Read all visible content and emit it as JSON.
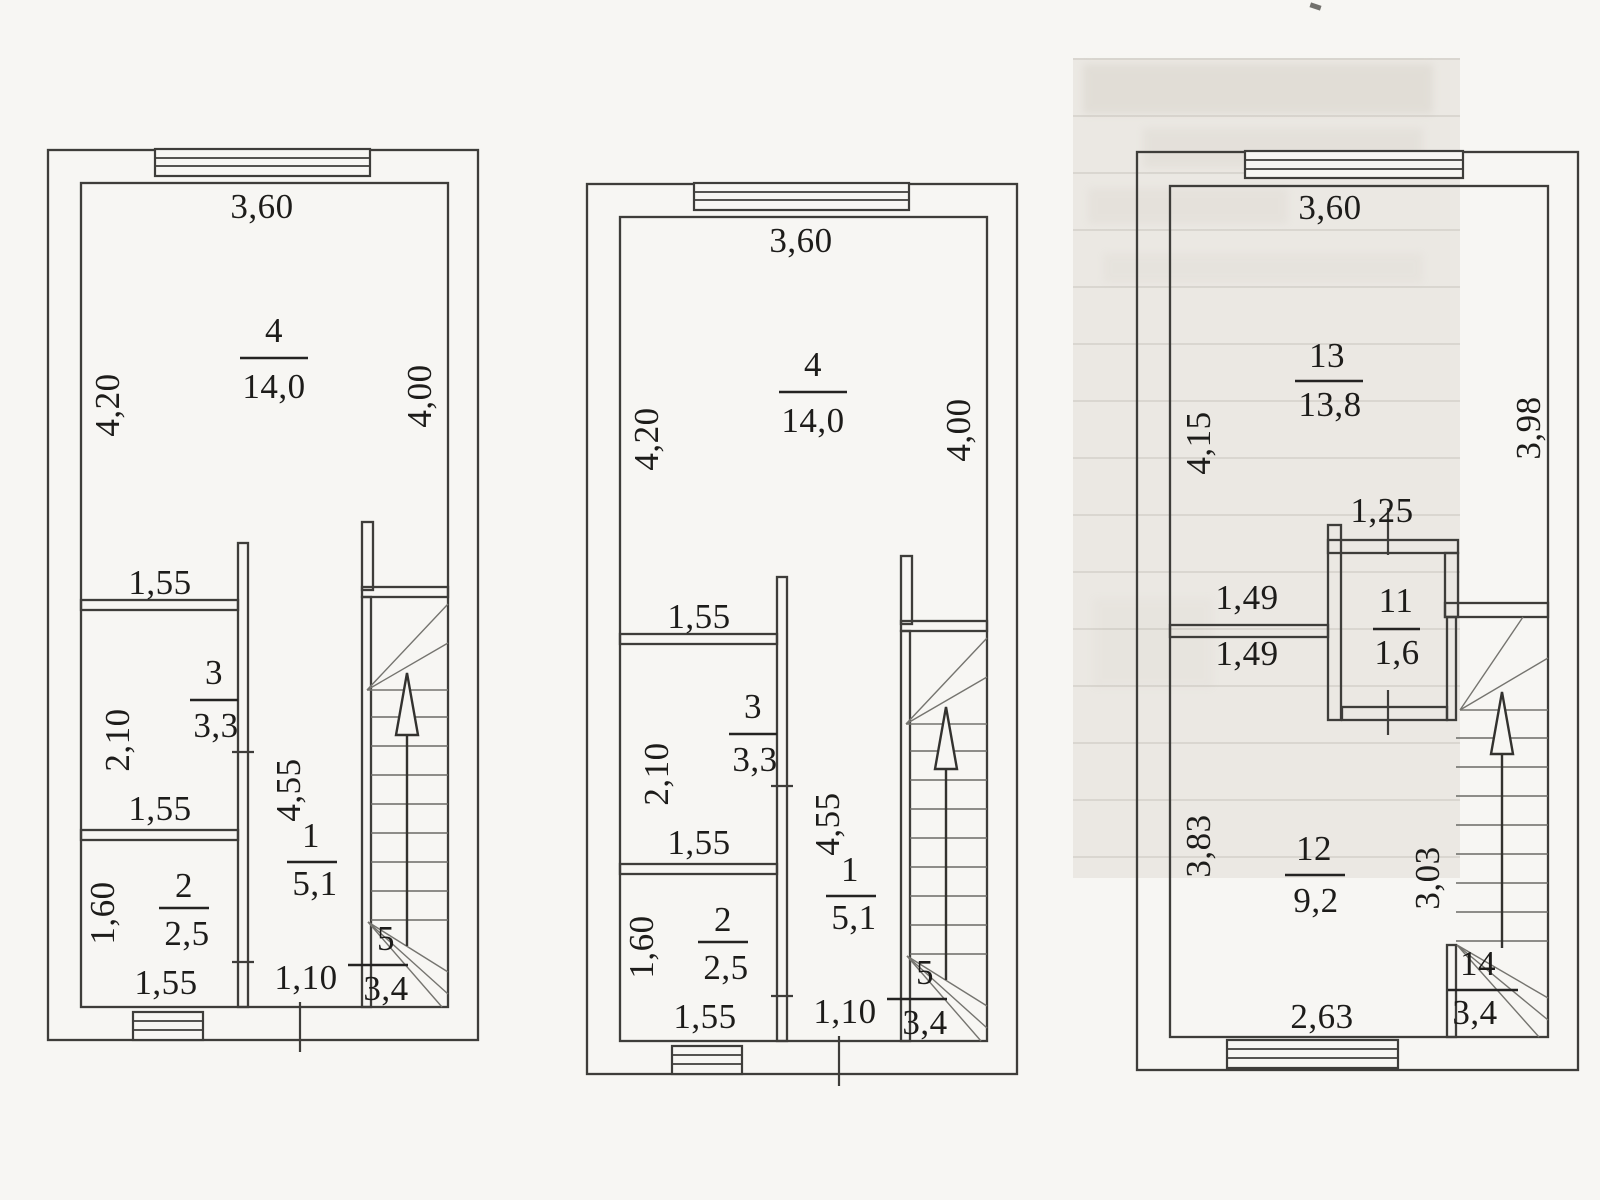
{
  "colors": {
    "line": "#3e3d3a",
    "text": "#1d1c1a",
    "paper": "#f7f6f3",
    "scan_band": "#ebe8e3"
  },
  "plans": [
    {
      "id": "floor-plan-1",
      "dims": {
        "top": "3,60",
        "left": "4,20",
        "right": "4,00",
        "room3_top": "1,55",
        "room3_left": "2,10",
        "room3_bottom": "1,55",
        "hall": "4,55",
        "room2_left": "1,60",
        "room2_bottom": "1,55",
        "door": "1,10"
      },
      "rooms": {
        "main": {
          "number": "4",
          "area": "14,0"
        },
        "room3": {
          "number": "3",
          "area": "3,3"
        },
        "room2": {
          "number": "2",
          "area": "2,5"
        },
        "hall": {
          "number": "1",
          "area": "5,1"
        },
        "stairs": {
          "number": "5",
          "area": "3,4"
        }
      }
    },
    {
      "id": "floor-plan-2",
      "dims": {
        "top": "3,60",
        "left": "4,20",
        "right": "4,00",
        "room3_top": "1,55",
        "room3_left": "2,10",
        "room3_bottom": "1,55",
        "hall": "4,55",
        "room2_left": "1,60",
        "room2_bottom": "1,55",
        "door": "1,10"
      },
      "rooms": {
        "main": {
          "number": "4",
          "area": "14,0"
        },
        "room3": {
          "number": "3",
          "area": "3,3"
        },
        "room2": {
          "number": "2",
          "area": "2,5"
        },
        "hall": {
          "number": "1",
          "area": "5,1"
        },
        "stairs": {
          "number": "5",
          "area": "3,4"
        }
      }
    },
    {
      "id": "floor-plan-3",
      "dims": {
        "top": "3,60",
        "left": "4,15",
        "right": "3,98",
        "closet_top": "1,25",
        "split_upper": "1,49",
        "split_lower": "1,49",
        "room12_left": "3,83",
        "stairs_side": "3,03",
        "bottom": "2,63"
      },
      "rooms": {
        "main": {
          "number": "13",
          "area": "13,8"
        },
        "closet": {
          "number": "11",
          "area": "1,6"
        },
        "room12": {
          "number": "12",
          "area": "9,2"
        },
        "stairs": {
          "number": "14",
          "area": "3,4"
        }
      }
    }
  ]
}
